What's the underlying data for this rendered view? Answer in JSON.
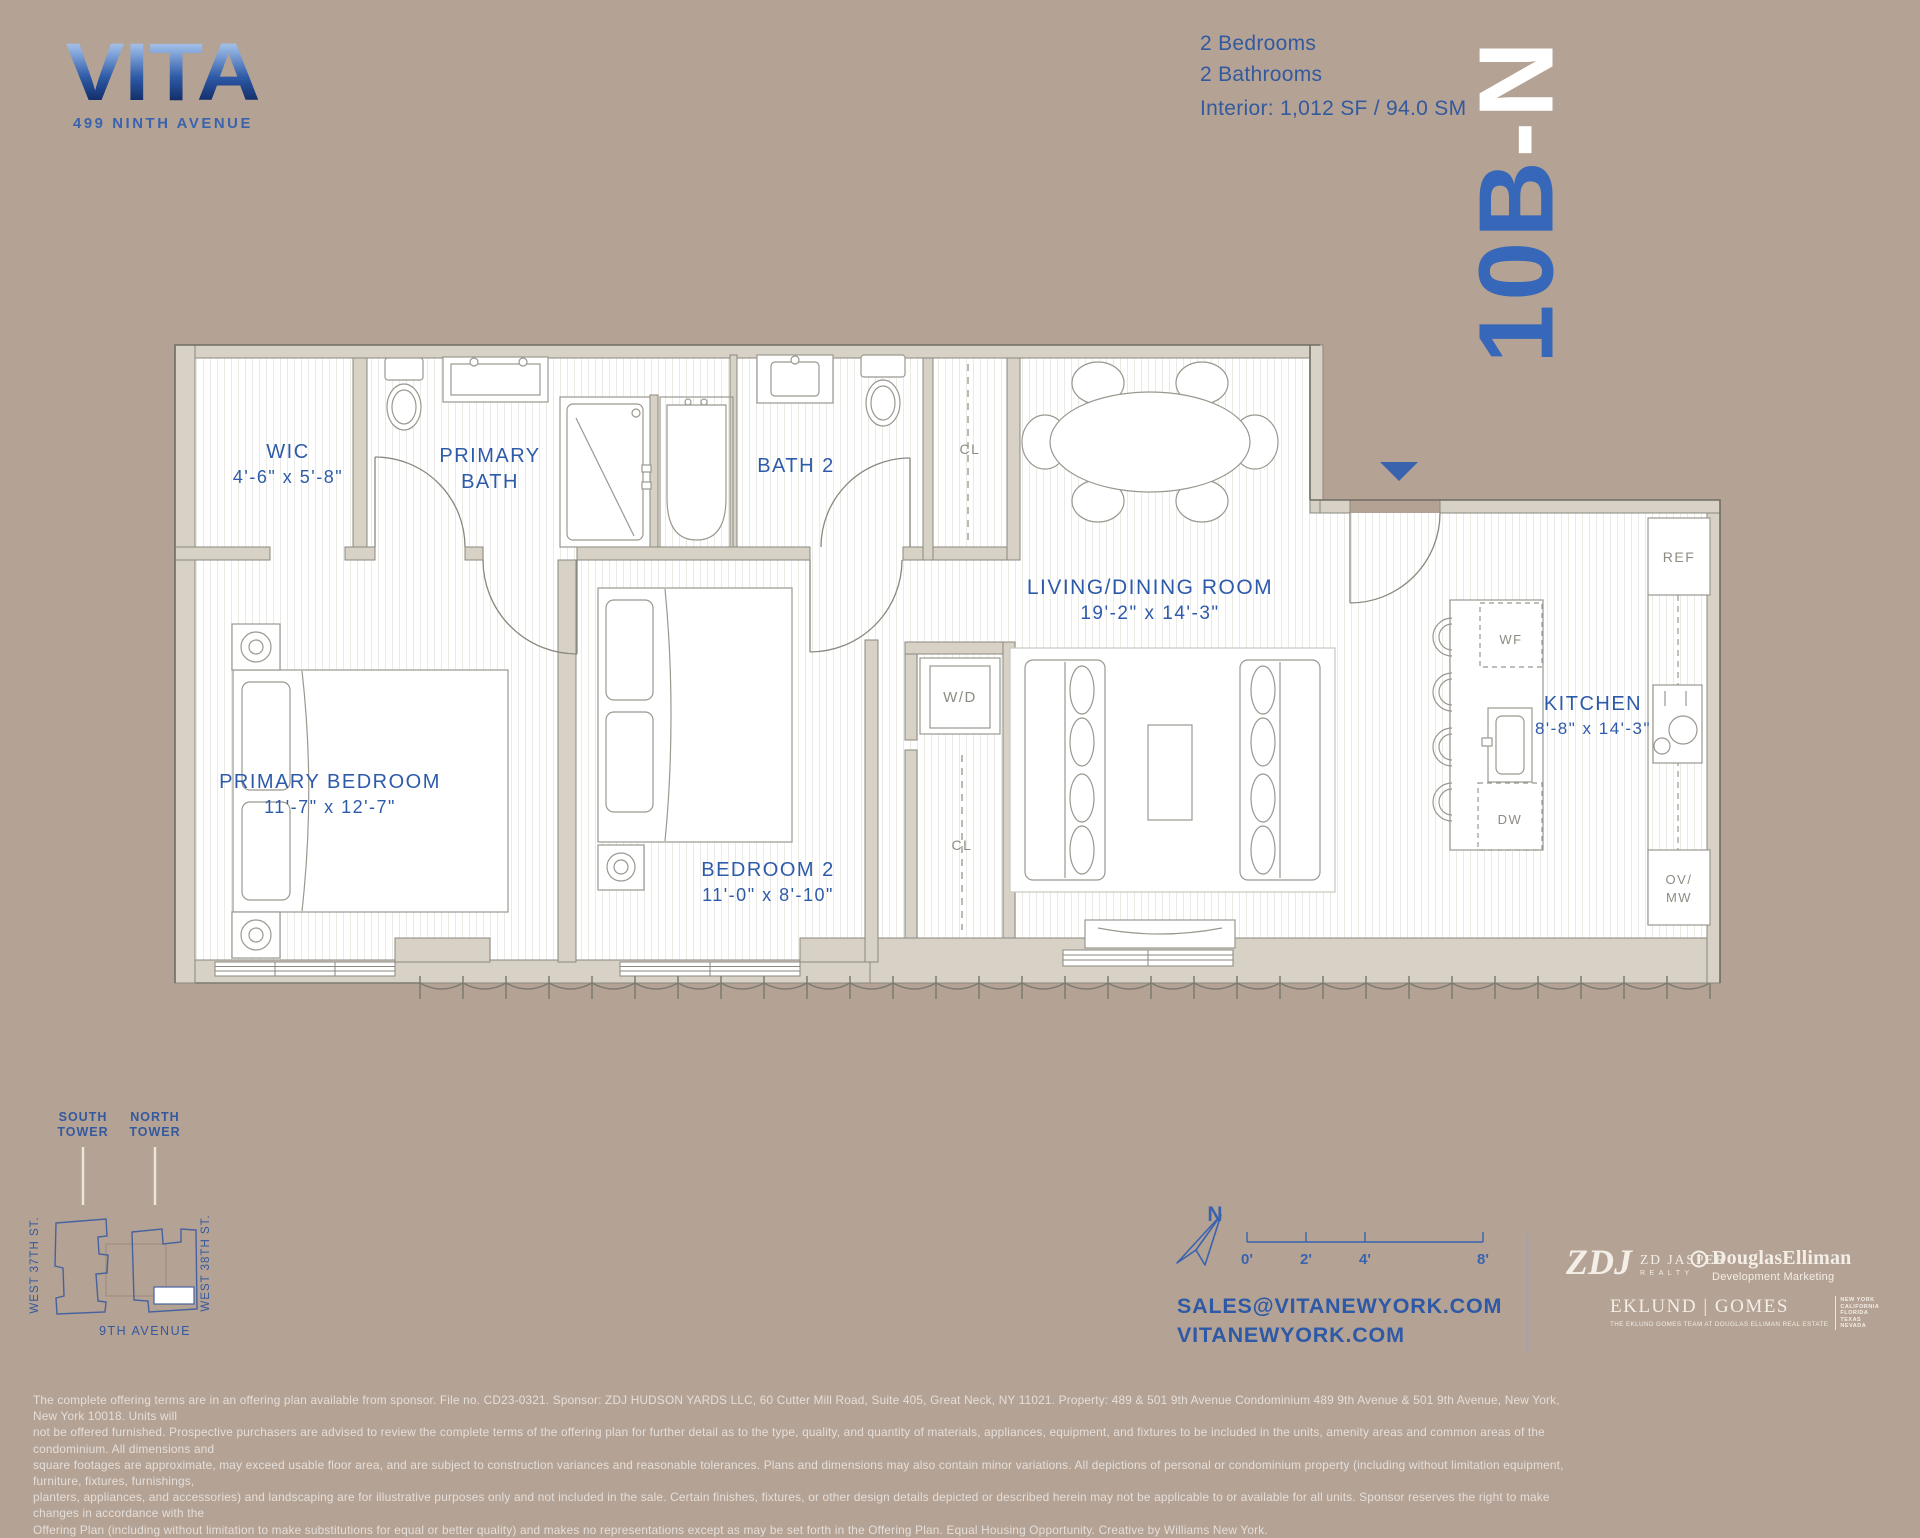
{
  "meta": {
    "background": "#b4a294",
    "accent_blue": "#3a63ae",
    "wall_fill": "#d8d2c6",
    "label_gray": "#8d8b82",
    "white": "#ffffff"
  },
  "logo": {
    "name": "VITA",
    "address": "499 NINTH AVENUE"
  },
  "unit": {
    "id": "10B-N",
    "blue_part": "10B",
    "white_part": "-N"
  },
  "summary": {
    "bedrooms": "2 Bedrooms",
    "bathrooms": "2 Bathrooms",
    "interior": "Interior: 1,012 SF / 94.0 SM"
  },
  "rooms": {
    "wic": {
      "label": "WIC",
      "dims": "4'-6\" x 5'-8\""
    },
    "primary_bath": {
      "line1": "PRIMARY",
      "line2": "BATH"
    },
    "bath2": {
      "label": "BATH 2"
    },
    "living": {
      "label": "LIVING/DINING ROOM",
      "dims": "19'-2\" x 14'-3\""
    },
    "primary_bedroom": {
      "label": "PRIMARY BEDROOM",
      "dims": "11'-7\" x 12'-7\""
    },
    "bedroom2": {
      "label": "BEDROOM 2",
      "dims": "11'-0\" x 8'-10\""
    },
    "kitchen": {
      "label": "KITCHEN",
      "dims": "8'-8\" x 14'-3\""
    }
  },
  "fixtures": {
    "closet_hall": "CL",
    "closet_center": "CL",
    "washer_dryer": "W/D",
    "fridge": "REF",
    "wine_fridge": "WF",
    "dishwasher": "DW",
    "oven_line1": "OV/",
    "oven_line2": "MW"
  },
  "site_map": {
    "south_line1": "SOUTH",
    "south_line2": "TOWER",
    "north_line1": "NORTH",
    "north_line2": "TOWER",
    "west_37": "WEST 37TH ST.",
    "west_38": "WEST 38TH ST.",
    "avenue": "9TH AVENUE"
  },
  "compass": {
    "north": "N"
  },
  "scale_bar": {
    "ticks": [
      "0'",
      "2'",
      "4'",
      "8'"
    ]
  },
  "contact": {
    "email": "SALES@VITANEWYORK.COM",
    "website": "VITANEWYORK.COM"
  },
  "brokers": {
    "zdj": {
      "monogram": "ZDJ",
      "name": "ZD JASPER",
      "subtitle": "REALTY"
    },
    "douglas": {
      "name": "DouglasElliman",
      "subtitle": "Development Marketing"
    },
    "eklund": {
      "name": "EKLUND | GOMES",
      "tagline": "THE EKLUND GOMES TEAM AT DOUGLAS ELLIMAN REAL ESTATE",
      "regions": [
        "NEW YORK",
        "CALIFORNIA",
        "FLORIDA",
        "TEXAS",
        "NEVADA"
      ]
    }
  },
  "disclaimer": {
    "lines": [
      "The complete offering terms are in an offering plan available from sponsor. File no. CD23-0321. Sponsor: ZDJ HUDSON YARDS LLC, 60 Cutter Mill Road, Suite 405, Great Neck, NY 11021. Property:  489 & 501 9th Avenue Condominium 489 9th Avenue & 501 9th Avenue, New York, New York 10018. Units will",
      "not be offered furnished. Prospective purchasers are advised to review the complete terms of the offering plan for further detail as to the type, quality, and quantity of materials, appliances, equipment, and fixtures to be included in the units, amenity areas and common areas of the condominium. All dimensions and",
      "square footages are approximate, may exceed usable floor area, and are subject to construction variances and reasonable tolerances. Plans and dimensions may also contain minor variations. All depictions of personal or condominium property (including without limitation equipment, furniture, fixtures, furnishings,",
      "planters, appliances, and accessories) and landscaping are for illustrative purposes only and not included in the sale. Certain finishes, fixtures, or other design details depicted or described herein may not be applicable to or available for all units. Sponsor reserves the right to make changes in accordance with the",
      "Offering Plan (including without limitation to make substitutions for equal or better quality) and makes no representations except as may be set forth in the Offering Plan. Equal Housing Opportunity. Creative by Williams New York."
    ]
  }
}
